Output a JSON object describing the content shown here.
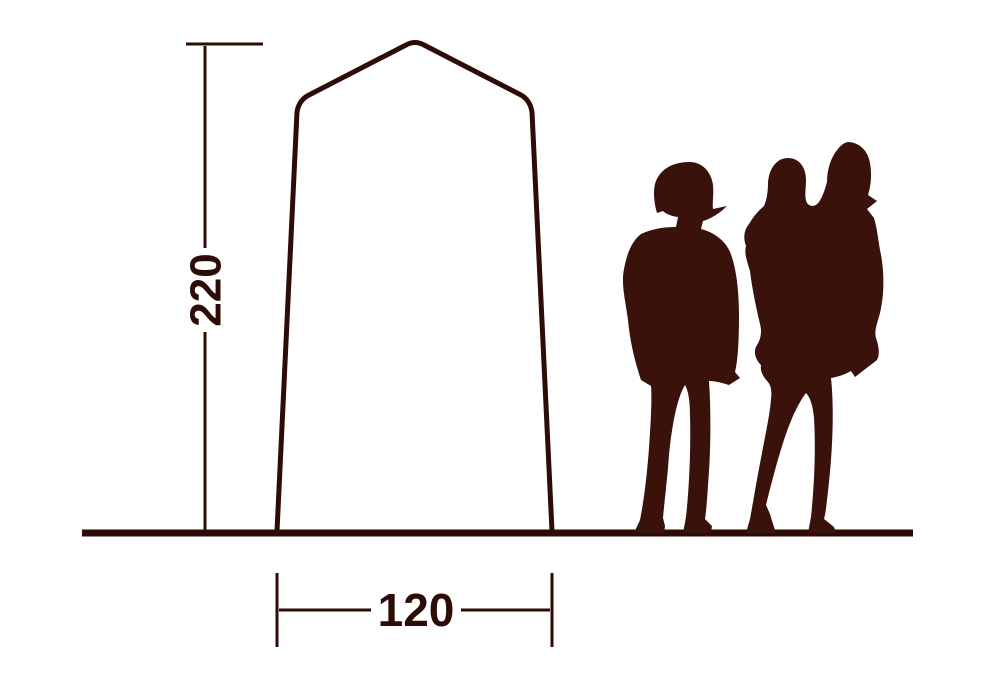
{
  "diagram": {
    "type": "tent-dimension-diagram",
    "height_label": "220",
    "width_label": "120",
    "figures": [
      "standing-adult-silhouette",
      "adult-carrying-child-silhouette"
    ],
    "colors": {
      "ink": "#2d0c07",
      "silhouette": "#3a110b",
      "background": "#ffffff"
    }
  }
}
